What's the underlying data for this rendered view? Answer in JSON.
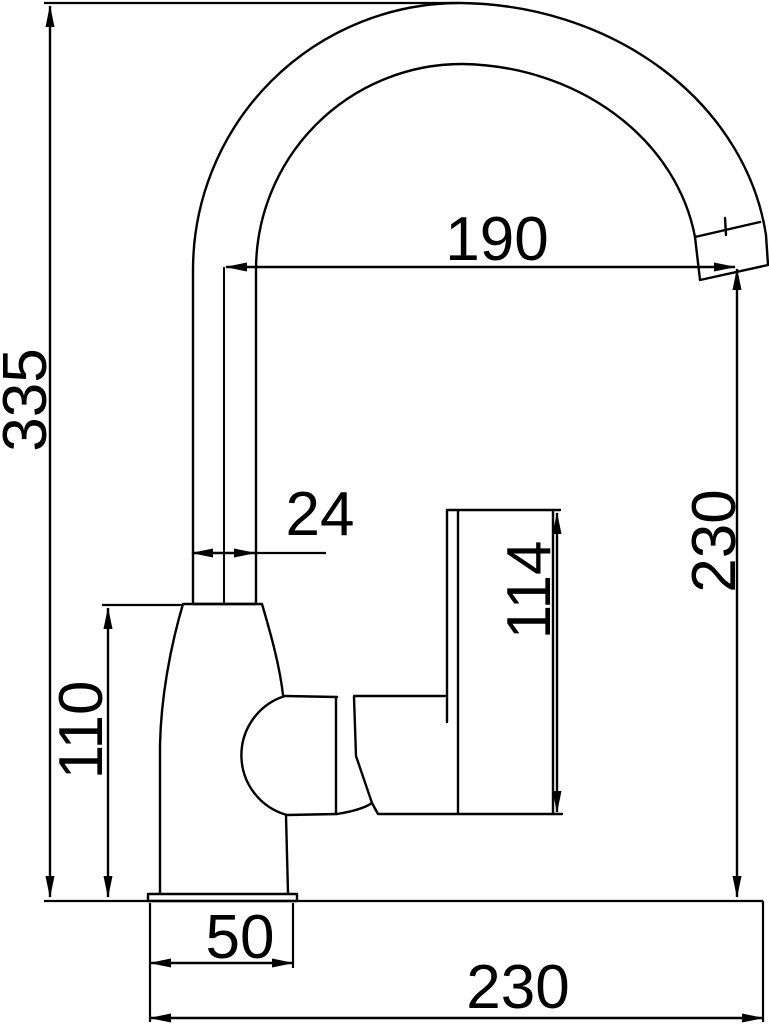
{
  "drawing": {
    "subject": "Kitchen faucet technical dimension drawing, side elevation",
    "unit": "mm",
    "background_color": "#ffffff",
    "line_color": "#000000",
    "dimensions": {
      "overall_height": "335",
      "spout_reach": "190",
      "spout_tube_width": "24",
      "handle_length": "114",
      "body_height": "110",
      "outlet_height": "230",
      "base_width": "50",
      "overall_depth": "230"
    }
  }
}
